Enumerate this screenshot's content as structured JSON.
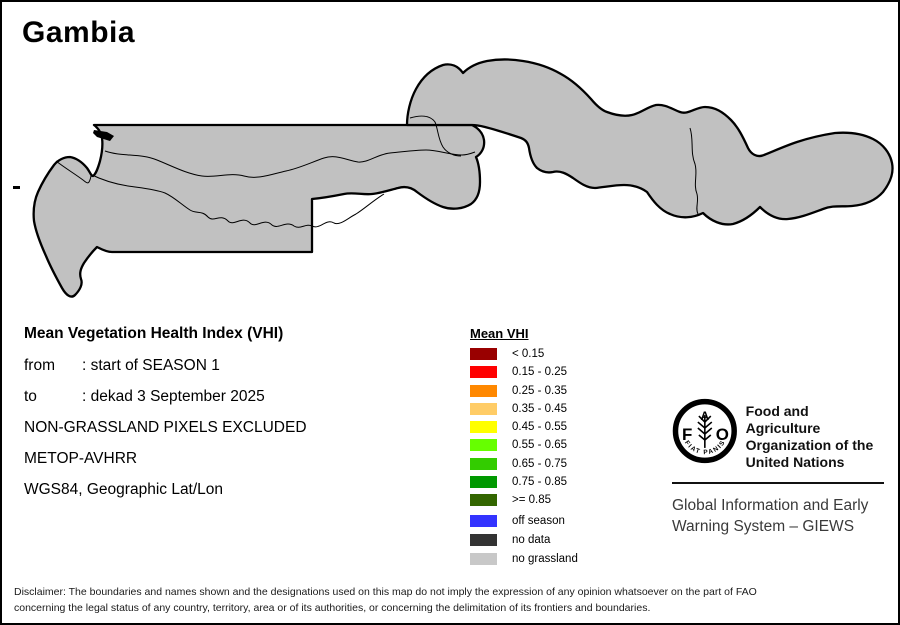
{
  "title": "Gambia",
  "info": {
    "heading": "Mean Vegetation Health Index (VHI)",
    "rows": [
      {
        "label": "from",
        "value": ": start of SEASON 1"
      },
      {
        "label": "to",
        "value": ": dekad 3 September 2025"
      }
    ],
    "lines": [
      "NON-GRASSLAND PIXELS EXCLUDED",
      "METOP-AVHRR",
      "WGS84, Geographic Lat/Lon"
    ]
  },
  "legend": {
    "title": "Mean VHI",
    "classes": [
      {
        "label": "< 0.15",
        "color": "#990000"
      },
      {
        "label": "0.15 - 0.25",
        "color": "#FF0000"
      },
      {
        "label": "0.25 - 0.35",
        "color": "#FF8800"
      },
      {
        "label": "0.35 - 0.45",
        "color": "#FFCC66"
      },
      {
        "label": "0.45 - 0.55",
        "color": "#FFFF00"
      },
      {
        "label": "0.55 - 0.65",
        "color": "#66FF00"
      },
      {
        "label": "0.65 - 0.75",
        "color": "#33CC00"
      },
      {
        "label": "0.75 - 0.85",
        "color": "#009900"
      },
      {
        "label": ">= 0.85",
        "color": "#336600"
      }
    ],
    "extra": [
      {
        "label": "off season",
        "color": "#3333FF"
      },
      {
        "label": "no data",
        "color": "#333333"
      },
      {
        "label": "no grassland",
        "color": "#C8C8C8"
      }
    ]
  },
  "branding": {
    "logo_letters": {
      "f": "F",
      "a": "A",
      "o": "O"
    },
    "logo_motto": "FIAT PANIS",
    "org_lines": [
      "Food and Agriculture",
      "Organization of the",
      "United Nations"
    ],
    "giews_lines": [
      "Global Information and Early",
      "Warning System – GIEWS"
    ]
  },
  "disclaimer_lines": [
    "Disclaimer: The boundaries and names shown and the designations used on this map do not imply the expression of any opinion whatsoever on the part of FAO",
    "concerning the legal status of any country, territory, area or of its authorities, or concerning the delimitation of its frontiers and boundaries."
  ],
  "map": {
    "land_fill": "#C1C1C1",
    "border_color": "#000000",
    "pixel_size": 4.5,
    "palette": {
      "y": "#FFFF00",
      "l": "#66FF00",
      "g": "#33CC00",
      "m": "#009900",
      "d": "#336600",
      "t": "#FFCC66",
      "o": "#FF8800",
      "w": "#FFFFFF"
    },
    "pixels": [
      [
        48,
        190,
        "t"
      ],
      [
        63,
        192,
        "y"
      ],
      [
        66,
        200,
        "y"
      ],
      [
        40,
        218,
        "y"
      ],
      [
        55,
        215,
        "g"
      ],
      [
        70,
        225,
        "g"
      ],
      [
        75,
        240,
        "g"
      ],
      [
        85,
        245,
        "l"
      ],
      [
        62,
        248,
        "g"
      ],
      [
        92,
        252,
        "g"
      ],
      [
        70,
        280,
        "l"
      ],
      [
        73,
        290,
        "g"
      ],
      [
        68,
        296,
        "l"
      ],
      [
        45,
        232,
        "l"
      ],
      [
        52,
        240,
        "m"
      ],
      [
        58,
        260,
        "g"
      ],
      [
        78,
        262,
        "l"
      ],
      [
        88,
        268,
        "g"
      ],
      [
        35,
        205,
        "g"
      ],
      [
        33,
        215,
        "l"
      ],
      [
        80,
        215,
        "y"
      ],
      [
        88,
        222,
        "g"
      ],
      [
        95,
        230,
        "l"
      ],
      [
        100,
        240,
        "g"
      ],
      [
        105,
        252,
        "g"
      ],
      [
        110,
        243,
        "l"
      ],
      [
        98,
        260,
        "g"
      ],
      [
        90,
        236,
        "y"
      ],
      [
        103,
        145,
        "g"
      ],
      [
        110,
        160,
        "m"
      ],
      [
        116,
        172,
        "d"
      ],
      [
        112,
        178,
        "l"
      ],
      [
        110,
        192,
        "y"
      ],
      [
        118,
        186,
        "g"
      ],
      [
        120,
        200,
        "l"
      ],
      [
        130,
        210,
        "g"
      ],
      [
        140,
        192,
        "g"
      ],
      [
        125,
        222,
        "g"
      ],
      [
        135,
        230,
        "l"
      ],
      [
        145,
        222,
        "g"
      ],
      [
        152,
        212,
        "l"
      ],
      [
        158,
        200,
        "g"
      ],
      [
        148,
        190,
        "l"
      ],
      [
        155,
        178,
        "g"
      ],
      [
        145,
        168,
        "l"
      ],
      [
        138,
        158,
        "g"
      ],
      [
        150,
        132,
        "g"
      ],
      [
        200,
        135,
        "l"
      ],
      [
        235,
        130,
        "g"
      ],
      [
        285,
        133,
        "g"
      ],
      [
        320,
        130,
        "l"
      ],
      [
        188,
        148,
        "d"
      ],
      [
        170,
        160,
        "l"
      ],
      [
        195,
        158,
        "y"
      ],
      [
        225,
        158,
        "l"
      ],
      [
        255,
        157,
        "y"
      ],
      [
        285,
        158,
        "g"
      ],
      [
        165,
        150,
        "g"
      ],
      [
        178,
        176,
        "y"
      ],
      [
        180,
        188,
        "w"
      ],
      [
        215,
        185,
        "l"
      ],
      [
        220,
        182,
        "l"
      ],
      [
        225,
        186,
        "l"
      ],
      [
        218,
        190,
        "l"
      ],
      [
        223,
        193,
        "l"
      ],
      [
        228,
        190,
        "g"
      ],
      [
        233,
        187,
        "l"
      ],
      [
        230,
        195,
        "l"
      ],
      [
        236,
        192,
        "g"
      ],
      [
        240,
        188,
        "l"
      ],
      [
        244,
        193,
        "l"
      ],
      [
        238,
        198,
        "l"
      ],
      [
        243,
        200,
        "g"
      ],
      [
        248,
        196,
        "l"
      ],
      [
        252,
        192,
        "l"
      ],
      [
        250,
        200,
        "g"
      ],
      [
        256,
        197,
        "l"
      ],
      [
        246,
        204,
        "y"
      ],
      [
        252,
        206,
        "l"
      ],
      [
        258,
        203,
        "l"
      ],
      [
        262,
        199,
        "g"
      ],
      [
        256,
        210,
        "g"
      ],
      [
        262,
        207,
        "l"
      ],
      [
        266,
        203,
        "l"
      ],
      [
        210,
        190,
        "g"
      ],
      [
        205,
        195,
        "l"
      ],
      [
        212,
        197,
        "y"
      ],
      [
        208,
        202,
        "l"
      ],
      [
        214,
        205,
        "g"
      ],
      [
        220,
        200,
        "y"
      ],
      [
        226,
        206,
        "l"
      ],
      [
        232,
        203,
        "l"
      ],
      [
        238,
        207,
        "y"
      ],
      [
        244,
        210,
        "l"
      ],
      [
        231,
        211,
        "l"
      ],
      [
        225,
        212,
        "g"
      ],
      [
        270,
        195,
        "g"
      ],
      [
        274,
        200,
        "l"
      ],
      [
        268,
        208,
        "m"
      ],
      [
        195,
        180,
        "y"
      ],
      [
        200,
        207,
        "y"
      ],
      [
        190,
        200,
        "g"
      ],
      [
        185,
        193,
        "g"
      ],
      [
        180,
        186,
        "t"
      ],
      [
        175,
        230,
        "g"
      ],
      [
        182,
        236,
        "l"
      ],
      [
        190,
        242,
        "g"
      ],
      [
        197,
        238,
        "l"
      ],
      [
        204,
        244,
        "g"
      ],
      [
        210,
        240,
        "m"
      ],
      [
        216,
        245,
        "l"
      ],
      [
        222,
        241,
        "g"
      ],
      [
        230,
        246,
        "l"
      ],
      [
        238,
        242,
        "g"
      ],
      [
        246,
        245,
        "l"
      ],
      [
        253,
        240,
        "g"
      ],
      [
        260,
        244,
        "m"
      ],
      [
        267,
        240,
        "g"
      ],
      [
        274,
        244,
        "l"
      ],
      [
        281,
        240,
        "g"
      ],
      [
        288,
        244,
        "g"
      ],
      [
        296,
        240,
        "l"
      ],
      [
        302,
        244,
        "g"
      ],
      [
        248,
        232,
        "y"
      ],
      [
        235,
        233,
        "g"
      ],
      [
        220,
        234,
        "d"
      ],
      [
        265,
        233,
        "g"
      ],
      [
        280,
        232,
        "m"
      ],
      [
        310,
        158,
        "y"
      ],
      [
        322,
        166,
        "g"
      ],
      [
        335,
        172,
        "y"
      ],
      [
        348,
        178,
        "l"
      ],
      [
        360,
        170,
        "g"
      ],
      [
        372,
        176,
        "y"
      ],
      [
        384,
        168,
        "g"
      ],
      [
        350,
        175,
        "o"
      ],
      [
        338,
        162,
        "t"
      ],
      [
        328,
        185,
        "t"
      ],
      [
        395,
        178,
        "t"
      ],
      [
        405,
        170,
        "g"
      ],
      [
        415,
        176,
        "y"
      ],
      [
        425,
        182,
        "g"
      ],
      [
        435,
        175,
        "y"
      ],
      [
        445,
        182,
        "l"
      ],
      [
        460,
        175,
        "g"
      ],
      [
        452,
        190,
        "g"
      ],
      [
        440,
        195,
        "l"
      ],
      [
        362,
        149,
        "w"
      ],
      [
        420,
        160,
        "y"
      ],
      [
        430,
        152,
        "t"
      ],
      [
        427,
        147,
        "o"
      ],
      [
        412,
        130,
        "t"
      ],
      [
        472,
        133,
        "y"
      ],
      [
        448,
        122,
        "w"
      ],
      [
        408,
        95,
        "g"
      ],
      [
        412,
        102,
        "l"
      ],
      [
        418,
        88,
        "y"
      ],
      [
        425,
        80,
        "l"
      ],
      [
        432,
        72,
        "g"
      ],
      [
        440,
        78,
        "l"
      ],
      [
        445,
        85,
        "y"
      ],
      [
        450,
        78,
        "y"
      ],
      [
        457,
        82,
        "o"
      ],
      [
        452,
        90,
        "l"
      ],
      [
        445,
        95,
        "g"
      ],
      [
        438,
        100,
        "y"
      ],
      [
        430,
        108,
        "l"
      ],
      [
        422,
        115,
        "y"
      ],
      [
        460,
        95,
        "y"
      ],
      [
        468,
        88,
        "l"
      ],
      [
        475,
        92,
        "g"
      ],
      [
        482,
        86,
        "y"
      ],
      [
        478,
        78,
        "o"
      ],
      [
        490,
        82,
        "y"
      ],
      [
        497,
        86,
        "y"
      ],
      [
        503,
        80,
        "y"
      ],
      [
        510,
        85,
        "t"
      ],
      [
        517,
        80,
        "y"
      ],
      [
        523,
        61,
        "t"
      ],
      [
        533,
        80,
        "y"
      ],
      [
        537,
        82,
        "o"
      ],
      [
        540,
        85,
        "y"
      ],
      [
        545,
        88,
        "y"
      ],
      [
        550,
        80,
        "t"
      ],
      [
        555,
        90,
        "t"
      ],
      [
        548,
        92,
        "w"
      ],
      [
        533,
        92,
        "y"
      ],
      [
        530,
        100,
        "t"
      ],
      [
        503,
        101,
        "t"
      ],
      [
        528,
        110,
        "g"
      ],
      [
        535,
        113,
        "g"
      ],
      [
        542,
        118,
        "m"
      ],
      [
        580,
        91,
        "y"
      ],
      [
        555,
        71,
        "g"
      ],
      [
        588,
        128,
        "w"
      ],
      [
        527,
        131,
        "y"
      ],
      [
        531,
        137,
        "y"
      ],
      [
        536,
        135,
        "t"
      ],
      [
        538,
        145,
        "t"
      ],
      [
        543,
        150,
        "y"
      ],
      [
        490,
        105,
        "l"
      ],
      [
        483,
        110,
        "g"
      ],
      [
        470,
        105,
        "g"
      ],
      [
        462,
        110,
        "l"
      ],
      [
        475,
        115,
        "g"
      ],
      [
        567,
        140,
        "g"
      ],
      [
        573,
        144,
        "m"
      ],
      [
        578,
        148,
        "g"
      ],
      [
        590,
        140,
        "l"
      ],
      [
        612,
        120,
        "y"
      ],
      [
        600,
        150,
        "g"
      ],
      [
        610,
        160,
        "y"
      ],
      [
        622,
        168,
        "g"
      ],
      [
        633,
        160,
        "l"
      ],
      [
        645,
        152,
        "g"
      ],
      [
        640,
        170,
        "y"
      ],
      [
        655,
        160,
        "m"
      ],
      [
        660,
        153,
        "m"
      ],
      [
        677,
        162,
        "g"
      ],
      [
        685,
        152,
        "o"
      ],
      [
        668,
        145,
        "y"
      ],
      [
        692,
        168,
        "y"
      ],
      [
        700,
        175,
        "g"
      ],
      [
        710,
        180,
        "y"
      ],
      [
        656,
        170,
        "t"
      ],
      [
        672,
        178,
        "l"
      ],
      [
        705,
        160,
        "d"
      ],
      [
        695,
        118,
        "g"
      ],
      [
        712,
        122,
        "y"
      ],
      [
        662,
        112,
        "g"
      ],
      [
        725,
        190,
        "y"
      ],
      [
        730,
        218,
        "y"
      ],
      [
        735,
        215,
        "y"
      ],
      [
        732,
        205,
        "t"
      ],
      [
        742,
        196,
        "g"
      ],
      [
        755,
        188,
        "y"
      ],
      [
        762,
        190,
        "g"
      ],
      [
        775,
        210,
        "y"
      ],
      [
        773,
        218,
        "y"
      ],
      [
        788,
        196,
        "g"
      ],
      [
        800,
        190,
        "y"
      ],
      [
        812,
        184,
        "g"
      ],
      [
        820,
        176,
        "l"
      ],
      [
        832,
        180,
        "g"
      ],
      [
        845,
        172,
        "g"
      ],
      [
        856,
        165,
        "l"
      ],
      [
        868,
        170,
        "g"
      ],
      [
        880,
        172,
        "m"
      ],
      [
        847,
        145,
        "l"
      ],
      [
        836,
        158,
        "g"
      ],
      [
        808,
        170,
        "y"
      ],
      [
        792,
        178,
        "l"
      ],
      [
        765,
        175,
        "y"
      ],
      [
        748,
        180,
        "g"
      ],
      [
        758,
        200,
        "l"
      ],
      [
        778,
        188,
        "y"
      ]
    ]
  }
}
